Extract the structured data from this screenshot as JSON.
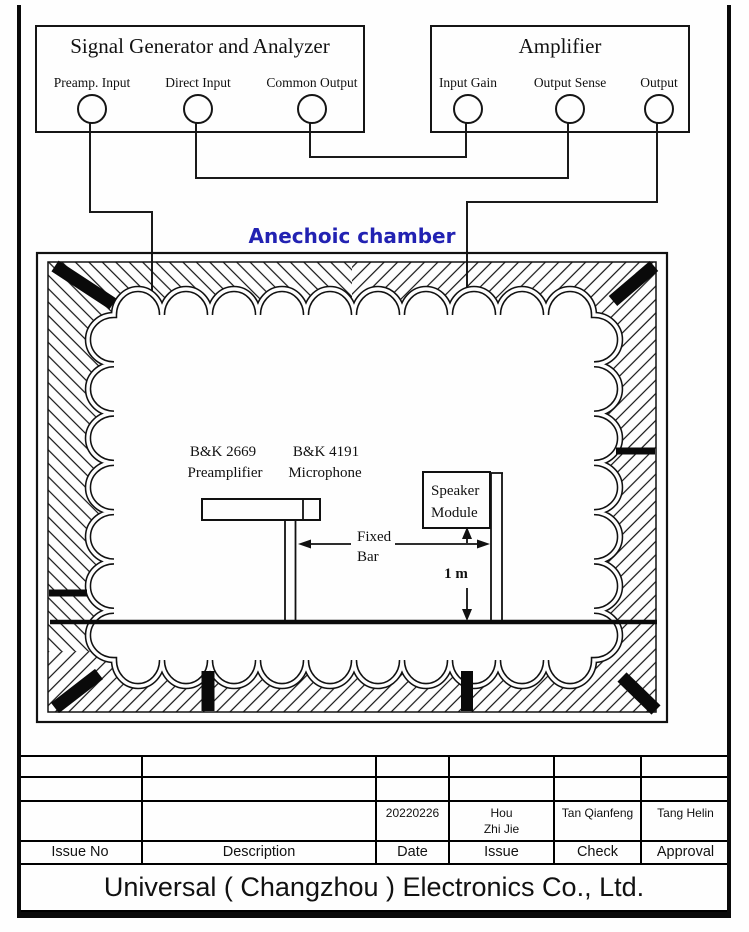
{
  "colors": {
    "line": "#111111",
    "chamber_title": "#2222b2",
    "black_fill": "#0a0a0a"
  },
  "signal_generator": {
    "title": "Signal Generator and Analyzer",
    "ports": [
      {
        "label": "Preamp. Input"
      },
      {
        "label": "Direct Input"
      },
      {
        "label": "Common Output"
      }
    ]
  },
  "amplifier": {
    "title": "Amplifier",
    "ports": [
      {
        "label": "Input Gain"
      },
      {
        "label": "Output Sense"
      },
      {
        "label": "Output"
      }
    ]
  },
  "chamber": {
    "title": "Anechoic chamber",
    "preamp_model": "B&K 2669",
    "preamp_name": "Preamplifier",
    "mic_model": "B&K 4191",
    "mic_name": "Microphone",
    "fixed_bar_line1": "Fixed",
    "fixed_bar_line2": "Bar",
    "speaker_line1": "Speaker",
    "speaker_line2": "Module",
    "distance_label": "1 m"
  },
  "title_block": {
    "headers": [
      "Issue No",
      "Description",
      "Date",
      "Issue",
      "Check",
      "Approval"
    ],
    "values": {
      "date": "20220226",
      "issue_line1": "Hou",
      "issue_line2": "Zhi Jie",
      "check": "Tan Qianfeng",
      "approval": "Tang Helin"
    },
    "company": "Universal ( Changzhou ) Electronics Co., Ltd."
  }
}
